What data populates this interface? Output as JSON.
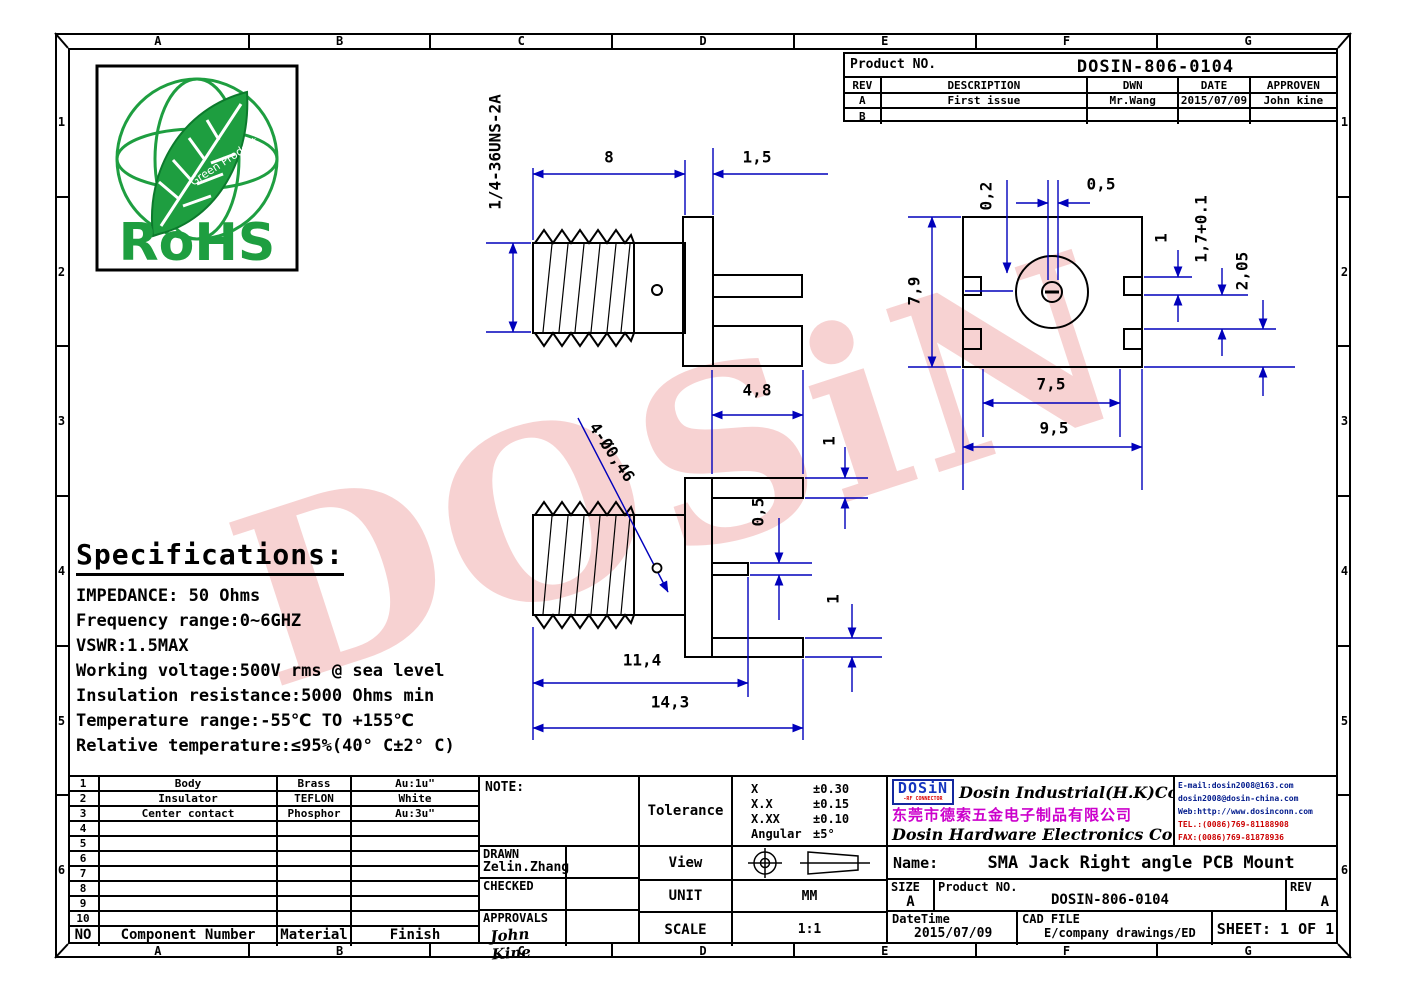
{
  "frame": {
    "top_letters": [
      "A",
      "B",
      "C",
      "D",
      "E",
      "F",
      "G"
    ],
    "bottom_letters": [
      "A",
      "B",
      "C",
      "D",
      "E",
      "F",
      "G"
    ],
    "left_numbers": [
      "1",
      "2",
      "3",
      "4",
      "5",
      "6"
    ],
    "right_numbers": [
      "1",
      "2",
      "3",
      "4",
      "5",
      "6"
    ]
  },
  "watermark": "DOSiN",
  "rohs": {
    "label": "RoHS",
    "sub": "Green Product"
  },
  "rev_table": {
    "product_no_label": "Product NO.",
    "product_no": "DOSIN-806-0104",
    "headers": [
      "REV",
      "DESCRIPTION",
      "DWN",
      "DATE",
      "APPROVEN"
    ],
    "rows": [
      [
        "A",
        "First issue",
        "Mr.Wang",
        "2015/07/09",
        "John kine"
      ],
      [
        "B",
        "",
        "",
        "",
        ""
      ]
    ]
  },
  "specs": {
    "title": "Specifications:",
    "lines": [
      "IMPEDANCE: 50 Ohms",
      "Frequency range:0~6GHZ",
      "VSWR:1.5MAX",
      "Working voltage:500V rms @ sea level",
      "Insulation resistance:5000 Ohms min",
      "Temperature range:-55℃ TO +155℃",
      "Relative temperature:≤95%(40° C±2° C)"
    ]
  },
  "parts_table": {
    "rows": [
      [
        "1",
        "Body",
        "Brass",
        "Au:1u\""
      ],
      [
        "2",
        "Insulator",
        "TEFLON",
        "White"
      ],
      [
        "3",
        "Center contact",
        "Phosphor",
        "Au:3u\""
      ],
      [
        "4",
        "",
        "",
        ""
      ],
      [
        "5",
        "",
        "",
        ""
      ],
      [
        "6",
        "",
        "",
        ""
      ],
      [
        "7",
        "",
        "",
        ""
      ],
      [
        "8",
        "",
        "",
        ""
      ],
      [
        "9",
        "",
        "",
        ""
      ],
      [
        "10",
        "",
        "",
        ""
      ]
    ],
    "footer": [
      "NO",
      "Component Number",
      "Material",
      "Finish"
    ]
  },
  "note_block": {
    "note_label": "NOTE:",
    "drawn_label": "DRAWN",
    "drawn_name": "Zelin.Zhang",
    "checked_label": "CHECKED",
    "approvals_label": "APPROVALS",
    "approvals_sign": "John Kine"
  },
  "tolerance_block": {
    "label": "Tolerance",
    "rows": [
      [
        "X",
        "±0.30"
      ],
      [
        "X.X",
        "±0.15"
      ],
      [
        "X.XX",
        "±0.10"
      ],
      [
        "Angular",
        "±5°"
      ]
    ],
    "view_label": "View",
    "unit_label": "UNIT",
    "unit_value": "MM",
    "scale_label": "SCALE",
    "scale_value": "1:1"
  },
  "company": {
    "logo": "DOSiN",
    "logo_sub": "-RF CONNECTOR",
    "en1": "Dosin Industrial(H.K)Co.,Ltd",
    "cn": "东莞市德索五金电子制品有限公司",
    "en2": "Dosin Hardware Electronics Co.,Ltd",
    "contact": [
      {
        "text": "E-mail:dosin2008@163.com",
        "tone": "blue"
      },
      {
        "text": "dosin2008@dosin-china.com",
        "tone": "blue"
      },
      {
        "text": "Web:http://www.dosinconn.com",
        "tone": "blue"
      },
      {
        "text": "TEL.:(0086)769-81188908",
        "tone": "red"
      },
      {
        "text": "FAX:(0086)769-81878936",
        "tone": "red"
      }
    ]
  },
  "title_block": {
    "name_label": "Name:",
    "name_value": "SMA Jack Right angle PCB Mount",
    "size_label": "SIZE",
    "size_value": "A",
    "product_label": "Product NO.",
    "product_value": "DOSIN-806-0104",
    "rev_label": "REV",
    "rev_value": "A",
    "datetime_label": "DateTime",
    "datetime_value": "2015/07/09",
    "cad_label": "CAD FILE",
    "cad_value": "E/company drawings/ED",
    "sheet_label": "SHEET: 1 OF 1"
  },
  "dim_labels": [
    {
      "t": "8",
      "x": 609,
      "y": 157,
      "r": 0
    },
    {
      "t": "1,5",
      "x": 757,
      "y": 157,
      "r": 0
    },
    {
      "t": "1/4-36UNS-2A",
      "x": 495,
      "y": 152,
      "r": -90
    },
    {
      "t": "4,8",
      "x": 757,
      "y": 390,
      "r": 0
    },
    {
      "t": "1",
      "x": 829,
      "y": 441,
      "r": -90
    },
    {
      "t": "0,5",
      "x": 758,
      "y": 512,
      "r": -90
    },
    {
      "t": "1",
      "x": 833,
      "y": 599,
      "r": -90
    },
    {
      "t": "11,4",
      "x": 642,
      "y": 660,
      "r": 0
    },
    {
      "t": "14,3",
      "x": 670,
      "y": 702,
      "r": 0
    },
    {
      "t": "4-Ø0,46",
      "x": 612,
      "y": 452,
      "r": 56
    },
    {
      "t": "0,2",
      "x": 986,
      "y": 196,
      "r": -90
    },
    {
      "t": "0,5",
      "x": 1101,
      "y": 184,
      "r": 0
    },
    {
      "t": "7,9",
      "x": 914,
      "y": 291,
      "r": -90
    },
    {
      "t": "1",
      "x": 1161,
      "y": 238,
      "r": -90
    },
    {
      "t": "1,7+0.1",
      "x": 1201,
      "y": 229,
      "r": -90
    },
    {
      "t": "2,05",
      "x": 1242,
      "y": 271,
      "r": -90
    },
    {
      "t": "7,5",
      "x": 1051,
      "y": 384,
      "r": 0
    },
    {
      "t": "9,5",
      "x": 1054,
      "y": 428,
      "r": 0
    }
  ],
  "colors": {
    "dim_blue": "#0000bb",
    "line_black": "#000000",
    "watermark_pink": "#eb9494",
    "logo_blue": "#1535c0",
    "magenta": "#cc00cc",
    "rohs_green": "#1e9e40",
    "contact_blue": "#001a8c",
    "contact_red": "#cc0000"
  }
}
